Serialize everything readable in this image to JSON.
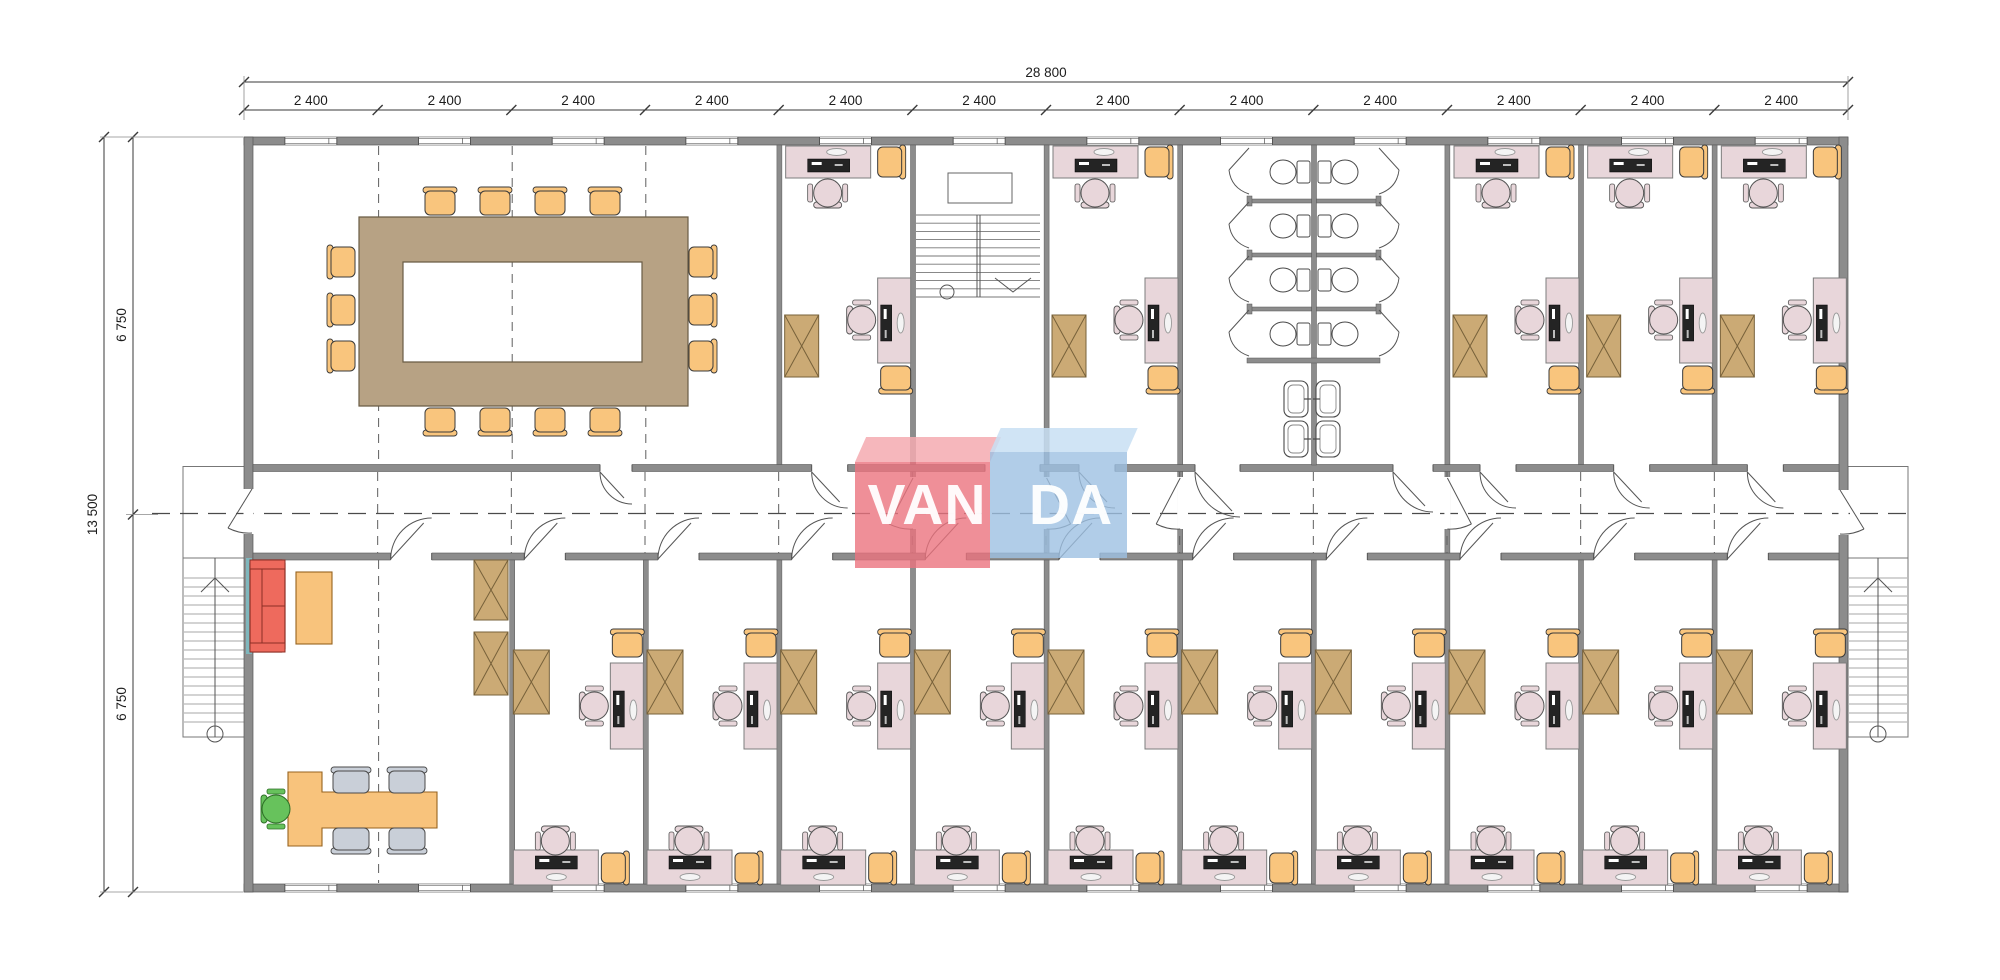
{
  "page": {
    "background": "#ffffff"
  },
  "dimensions": {
    "top_total_label": "28 800",
    "bay_label": "2 400",
    "bay_count": 12,
    "left_total_label": "13 500",
    "left_upper_label": "6 750",
    "left_lower_label": "6 750"
  },
  "watermark": {
    "left_text": "VAN",
    "right_text": "DA",
    "red_face": "rgba(235,115,126,0.80)",
    "red_top": "rgba(244,170,176,0.85)",
    "blue_face": "rgba(158,192,226,0.80)",
    "blue_top": "rgba(200,223,243,0.85)",
    "text_color": "rgba(255,255,255,0.95)"
  },
  "palette": {
    "wall": "#8c8c8c",
    "wall_dark": "#565656",
    "line": "#3a3a3a",
    "ext_line": "#8a8a8a",
    "dash": "#5f5f5f",
    "text": "#1c1c1c",
    "desk": "#e8d6da",
    "desk_stroke": "#7d7d7d",
    "chair_pink": "#e8d6da",
    "chair_pink_stroke": "#555555",
    "chair_orange": "#f9c57d",
    "chair_orange_stroke": "#3a3a3a",
    "cabinet": "#cbaa75",
    "cabinet_stroke": "#77613a",
    "table": "#b7a284",
    "table_stroke": "#6a5c45",
    "sofa": "#ee6a5d",
    "sofa_stroke": "#8c2e25",
    "lobby_table": "#f8c37c",
    "lobby_table_stroke": "#97631f",
    "chair_green": "#67c25c",
    "chair_green_stroke": "#2d6e26",
    "chair_gray": "#c9cfd8",
    "chair_gray_stroke": "#4a4a4a",
    "monitor": "#242424",
    "fixture_stroke": "#4a4a4a",
    "stair_line": "#777777",
    "accent_teal": "#7fb7bd"
  },
  "rooms": {
    "top_row": [
      {
        "name": "conference-room",
        "bays": "1-4",
        "seats": 14
      },
      {
        "name": "office",
        "bays": "5"
      },
      {
        "name": "stairwell",
        "bays": "6"
      },
      {
        "name": "office",
        "bays": "7"
      },
      {
        "name": "washrooms",
        "bays": "8-9",
        "toilet_stalls": 8,
        "sinks": 4
      },
      {
        "name": "office",
        "bays": "10"
      },
      {
        "name": "office",
        "bays": "11"
      },
      {
        "name": "office",
        "bays": "12"
      }
    ],
    "bottom_row": [
      {
        "name": "reception-lobby",
        "bays": "1-2"
      },
      {
        "name": "office",
        "bays": "3"
      },
      {
        "name": "office",
        "bays": "4"
      },
      {
        "name": "office",
        "bays": "5"
      },
      {
        "name": "office",
        "bays": "6"
      },
      {
        "name": "office",
        "bays": "7"
      },
      {
        "name": "office",
        "bays": "8"
      },
      {
        "name": "office",
        "bays": "9"
      },
      {
        "name": "office",
        "bays": "10"
      },
      {
        "name": "office",
        "bays": "11"
      },
      {
        "name": "office",
        "bays": "12"
      }
    ]
  }
}
